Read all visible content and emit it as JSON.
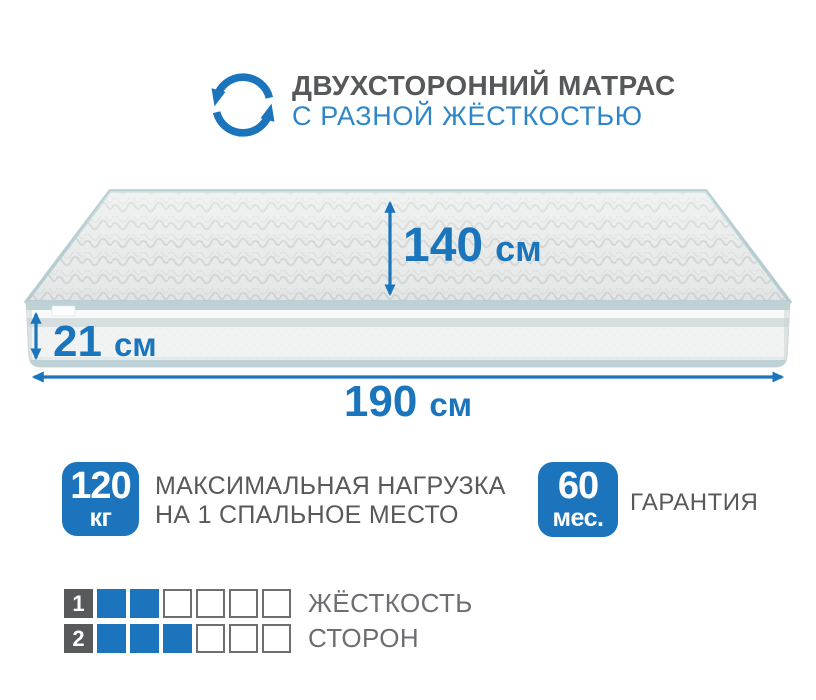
{
  "header": {
    "title": "ДВУХСТОРОННИЙ МАТРАС",
    "subtitle": "С РАЗНОЙ ЖЁСТКОСТЬЮ",
    "icon": "rotate-arrows-icon"
  },
  "mattress": {
    "width_label": {
      "value": "140",
      "unit": "см"
    },
    "height_label": {
      "value": "21",
      "unit": "см"
    },
    "length_label": {
      "value": "190",
      "unit": "см"
    }
  },
  "features": {
    "max_load": {
      "value": "120",
      "unit": "кг",
      "line1": "МАКСИМАЛЬНАЯ НАГРУЗКА",
      "line2": "НА 1 СПАЛЬНОЕ МЕСТО"
    },
    "warranty": {
      "value": "60",
      "unit": "мес.",
      "label": "ГАРАНТИЯ"
    }
  },
  "firmness": {
    "rows": [
      {
        "label": "1",
        "filled": 2,
        "total": 6,
        "text": "ЖЁСТКОСТЬ"
      },
      {
        "label": "2",
        "filled": 3,
        "total": 6,
        "text": "СТОРОН"
      }
    ]
  },
  "colors": {
    "accent_blue": "#1c75bc",
    "subtitle_blue": "#2e86c8",
    "dark_gray": "#58595b",
    "cell_border_gray": "#6d6e71",
    "piping_teal": "#b5ccd1",
    "mattress_top": "#e9ebeb",
    "mattress_side": "#f1f3f3"
  }
}
